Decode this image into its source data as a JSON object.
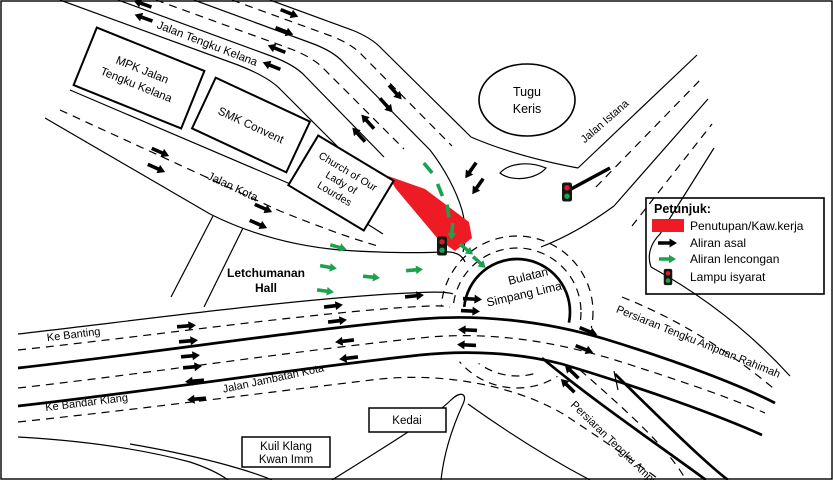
{
  "colors": {
    "closure": "#EE1B24",
    "diversion": "#1CA24D",
    "ink": "#000000"
  },
  "legend": {
    "title": "Petunjuk:",
    "items": {
      "closure": "Penutupan/Kaw.kerja",
      "asal": "Aliran asal",
      "lencongan": "Aliran lencongan",
      "lampu": "Lampu isyarat"
    }
  },
  "places": {
    "mpk": {
      "l1": "MPK Jalan",
      "l2": "Tengku Kelana"
    },
    "smk": {
      "l1": "SMK Convent"
    },
    "church": {
      "l1": "Church of Our",
      "l2": "Lady of",
      "l3": "Lourdes"
    },
    "tugu": {
      "l1": "Tugu",
      "l2": "Keris"
    },
    "letchumanan": {
      "l1": "Letchumanan",
      "l2": "Hall"
    },
    "kuil": {
      "l1": "Kuil Klang",
      "l2": "Kwan Imm"
    },
    "kedai": {
      "l1": "Kedai"
    }
  },
  "roads": {
    "jalan_tengku_kelana": "Jalan Tengku Kelana",
    "jalan_kota": "Jalan Kota",
    "jalan_istana": "Jalan Istana",
    "ke_banting": "Ke Banting",
    "ke_bandar_klang": "Ke Bandar Klang",
    "jalan_jambatan_kota": "Jalan Jambatan Kota",
    "persiaran_rahimah": "Persiaran Tengku Ampuan Rahimah",
    "persiaran_ampuan": "Persiaran Tengku Ampu",
    "bulatan": {
      "l1": "Bulatan",
      "l2": "Simpang Lima"
    }
  }
}
